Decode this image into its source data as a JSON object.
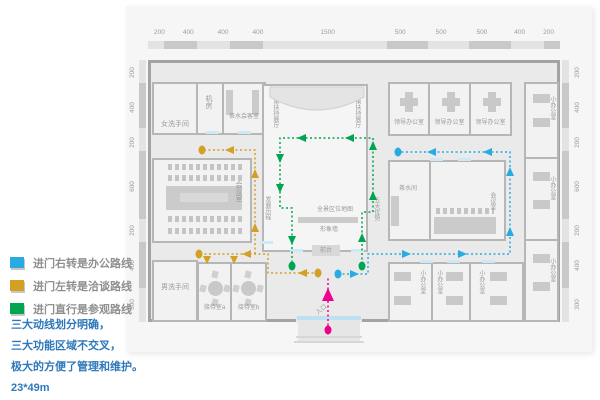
{
  "legend": [
    {
      "name": "office",
      "label": "进门右转是办公路线",
      "color": "#29abe2"
    },
    {
      "name": "negotiation",
      "label": "进门左转是洽谈路线",
      "color": "#d2a024"
    },
    {
      "name": "visit",
      "label": "进门直行是参观路线",
      "color": "#00a551"
    }
  ],
  "notes": [
    "三大动线划分明确，",
    "三大功能区域不交叉，",
    "极大的方便了管理和维护。",
    "23*49m"
  ],
  "dimensions": {
    "top": [
      "200",
      "400",
      "400",
      "400",
      "1500",
      "500",
      "500",
      "500",
      "400",
      "200"
    ],
    "left": [
      "200",
      "400",
      "200",
      "600",
      "200",
      "400",
      "300"
    ],
    "right": [
      "200",
      "400",
      "200",
      "600",
      "200",
      "400",
      "300"
    ]
  },
  "rooms": {
    "women_restroom": "女洗手间",
    "machine_room": "机房",
    "tea_reception_room": "茶水会客室",
    "tech_salon": "科技沙龙",
    "policy_hall": "政策扶持展厅",
    "dev_history": "发展历程",
    "five_advantages": "五大优势",
    "panorama_map": "全景区位地图",
    "image_wall": "形象墙",
    "front_desk": "前台",
    "meeting_room": "会议室",
    "leader_office": "领导办公室",
    "small_office": "小办公室",
    "tea_room": "茶水间",
    "men_restroom": "男洗手间",
    "reception_a": "接待室a",
    "reception_b": "接待室b",
    "entrance": "入口"
  },
  "route_colors": {
    "office_route": "#29abe2",
    "negotiation_route": "#d2a024",
    "visit_route": "#00a551",
    "entrance_route": "#ec008c"
  }
}
